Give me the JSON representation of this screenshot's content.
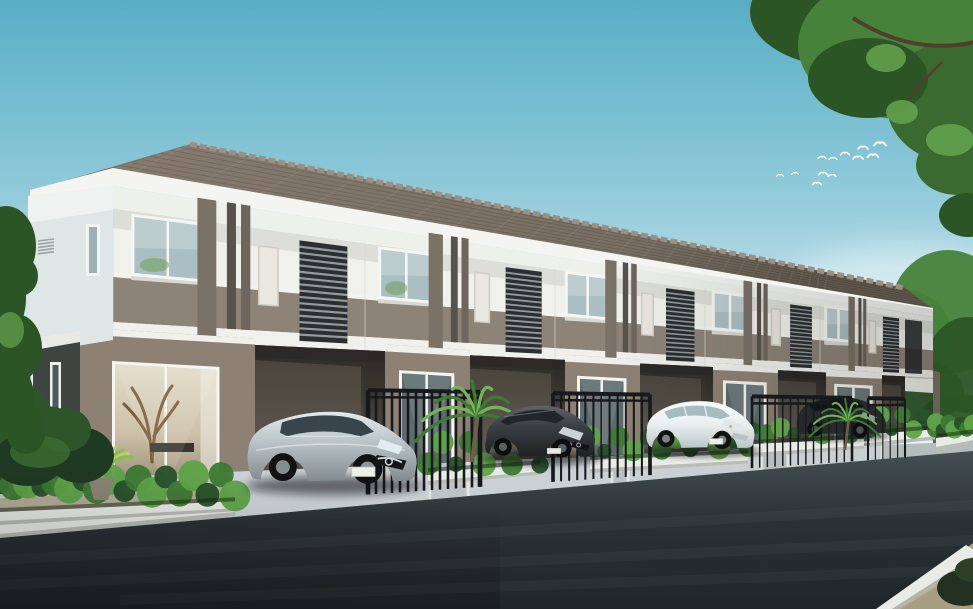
{
  "scene": {
    "subject": "two-storey modern townhouse row rendering with parked cars",
    "sky": {
      "top": "#58aec6",
      "mid": "#9fd2de",
      "horizon": "#eaf5f7",
      "cloud_color": "#ffffff",
      "bird_color": "#ffffff",
      "bird_count": 12,
      "cloud_count": 4
    },
    "building": {
      "unit_count": 5,
      "roof_tile": "#867b6e",
      "roof_dark": "#5f574c",
      "ridge": "#9a9083",
      "fascia": "#f4f5f0",
      "cornice": "#eef0ea",
      "upper_wall": "#f1f1eb",
      "upper_wall_shade": "#dddcd4",
      "spandrel_band": "#8d8377",
      "floor_band": "#f0f1ec",
      "stripe_medium": "#7b7267",
      "stripe_dark": "#57524b",
      "stripe_mid2": "#6e665e",
      "louver_face": "#2c2e30",
      "louver_slat": "#a7adb1",
      "matte_panel": "#e9e7df",
      "window_frame": "#f6f7f3",
      "window_glass": "#aabfc3",
      "ground_wall": "#8d8173",
      "carport_shadow": "#3a362f",
      "soffit": "#2b2926",
      "side_wall_upper": "#dfe7e6",
      "side_wall_lower": "#3f4541",
      "door_interior_warm": "#cdc2a9",
      "door_glass_cool": "#5d6b6d"
    },
    "fence": {
      "color": "#17191c",
      "segment_count": 4
    },
    "landscape": {
      "hedge_dark": "#27512a",
      "hedge_mid": "#3d7a33",
      "hedge_light": "#5ea348",
      "palm_frond": "#3f7a33",
      "palm_light": "#74b356",
      "accent_plant": "#b9d06a",
      "tree_leaf_dark": "#2c5526",
      "tree_leaf_mid": "#47823a",
      "tree_leaf_light": "#66a44e",
      "branch": "#503f2a",
      "curb": "#e9ebe7",
      "curb_shade": "#b9bdb6",
      "pavement": "#c6cdd0",
      "pavement_far": "#b2bbbe",
      "tan_ground": "#b3aa92",
      "corner_ground": "#a89f82"
    },
    "road": {
      "asphalt": "#2a3134",
      "asphalt_far": "#454f53",
      "asphalt_near": "#1f2629"
    },
    "cars": [
      {
        "id": "car-1",
        "type": "sedan",
        "body_color": "#b9c3c7",
        "parked_at": "unit-1"
      },
      {
        "id": "car-2",
        "type": "hatchback",
        "body_color": "#3b4044",
        "parked_at": "unit-2"
      },
      {
        "id": "car-3",
        "type": "compact",
        "body_color": "#e9efef",
        "parked_at": "unit-3"
      },
      {
        "id": "car-4",
        "type": "suv",
        "body_color": "#26292c",
        "parked_at": "unit-4"
      }
    ]
  }
}
